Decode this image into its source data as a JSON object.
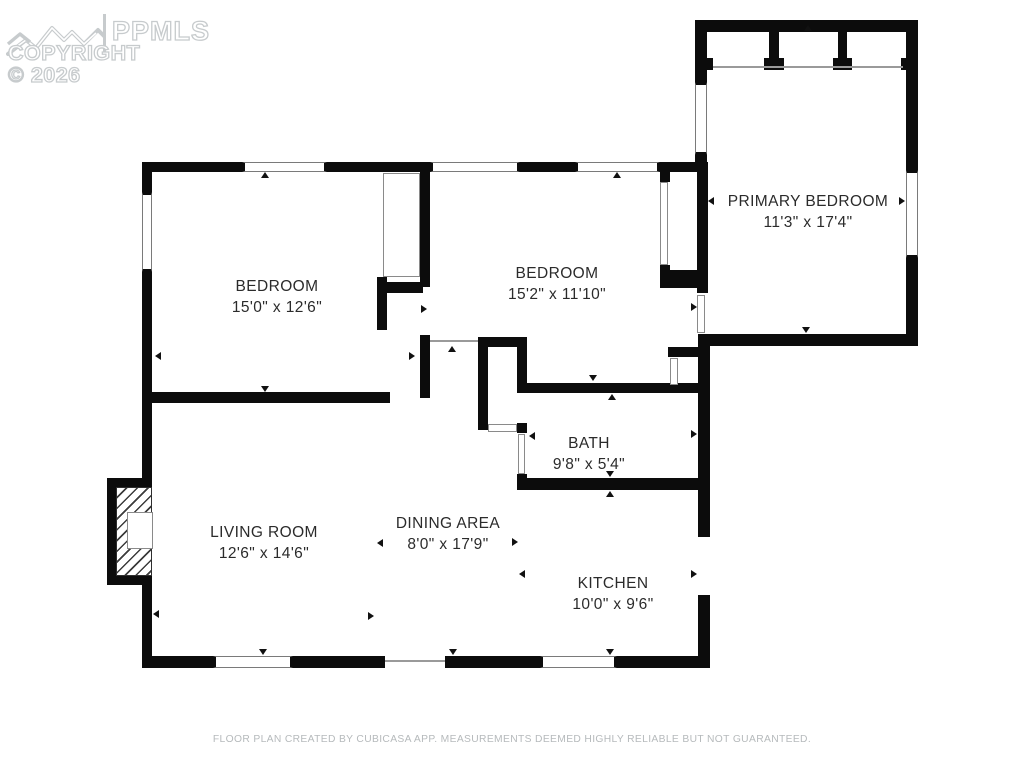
{
  "logo": {
    "mls_name": "PPMLS",
    "copyright": "COPYRIGHT © 2026",
    "mountain_icon": "mountain-ridge"
  },
  "rooms": [
    {
      "id": "primary-bedroom",
      "name": "PRIMARY BEDROOM",
      "dims": "11'3\" x 17'4\""
    },
    {
      "id": "bedroom-left",
      "name": "BEDROOM",
      "dims": "15'0\" x 12'6\""
    },
    {
      "id": "bedroom-middle",
      "name": "BEDROOM",
      "dims": "15'2\" x 11'10\""
    },
    {
      "id": "bath",
      "name": "BATH",
      "dims": "9'8\" x 5'4\""
    },
    {
      "id": "living-room",
      "name": "LIVING ROOM",
      "dims": "12'6\" x 14'6\""
    },
    {
      "id": "dining-area",
      "name": "DINING AREA",
      "dims": "8'0\" x 17'9\""
    },
    {
      "id": "kitchen",
      "name": "KITCHEN",
      "dims": "10'0\" x 9'6\""
    }
  ],
  "footer": {
    "disclaimer": "FLOOR PLAN CREATED BY CUBICASA APP. MEASUREMENTS DEEMED HIGHLY RELIABLE BUT NOT GUARANTEED."
  },
  "colors": {
    "wall": "#0c0c0c",
    "window_outline": "#7a7a7a",
    "logo_gray": "#c7cbcd",
    "footer_gray": "#b6babc",
    "label_text": "#2b2b2b"
  }
}
